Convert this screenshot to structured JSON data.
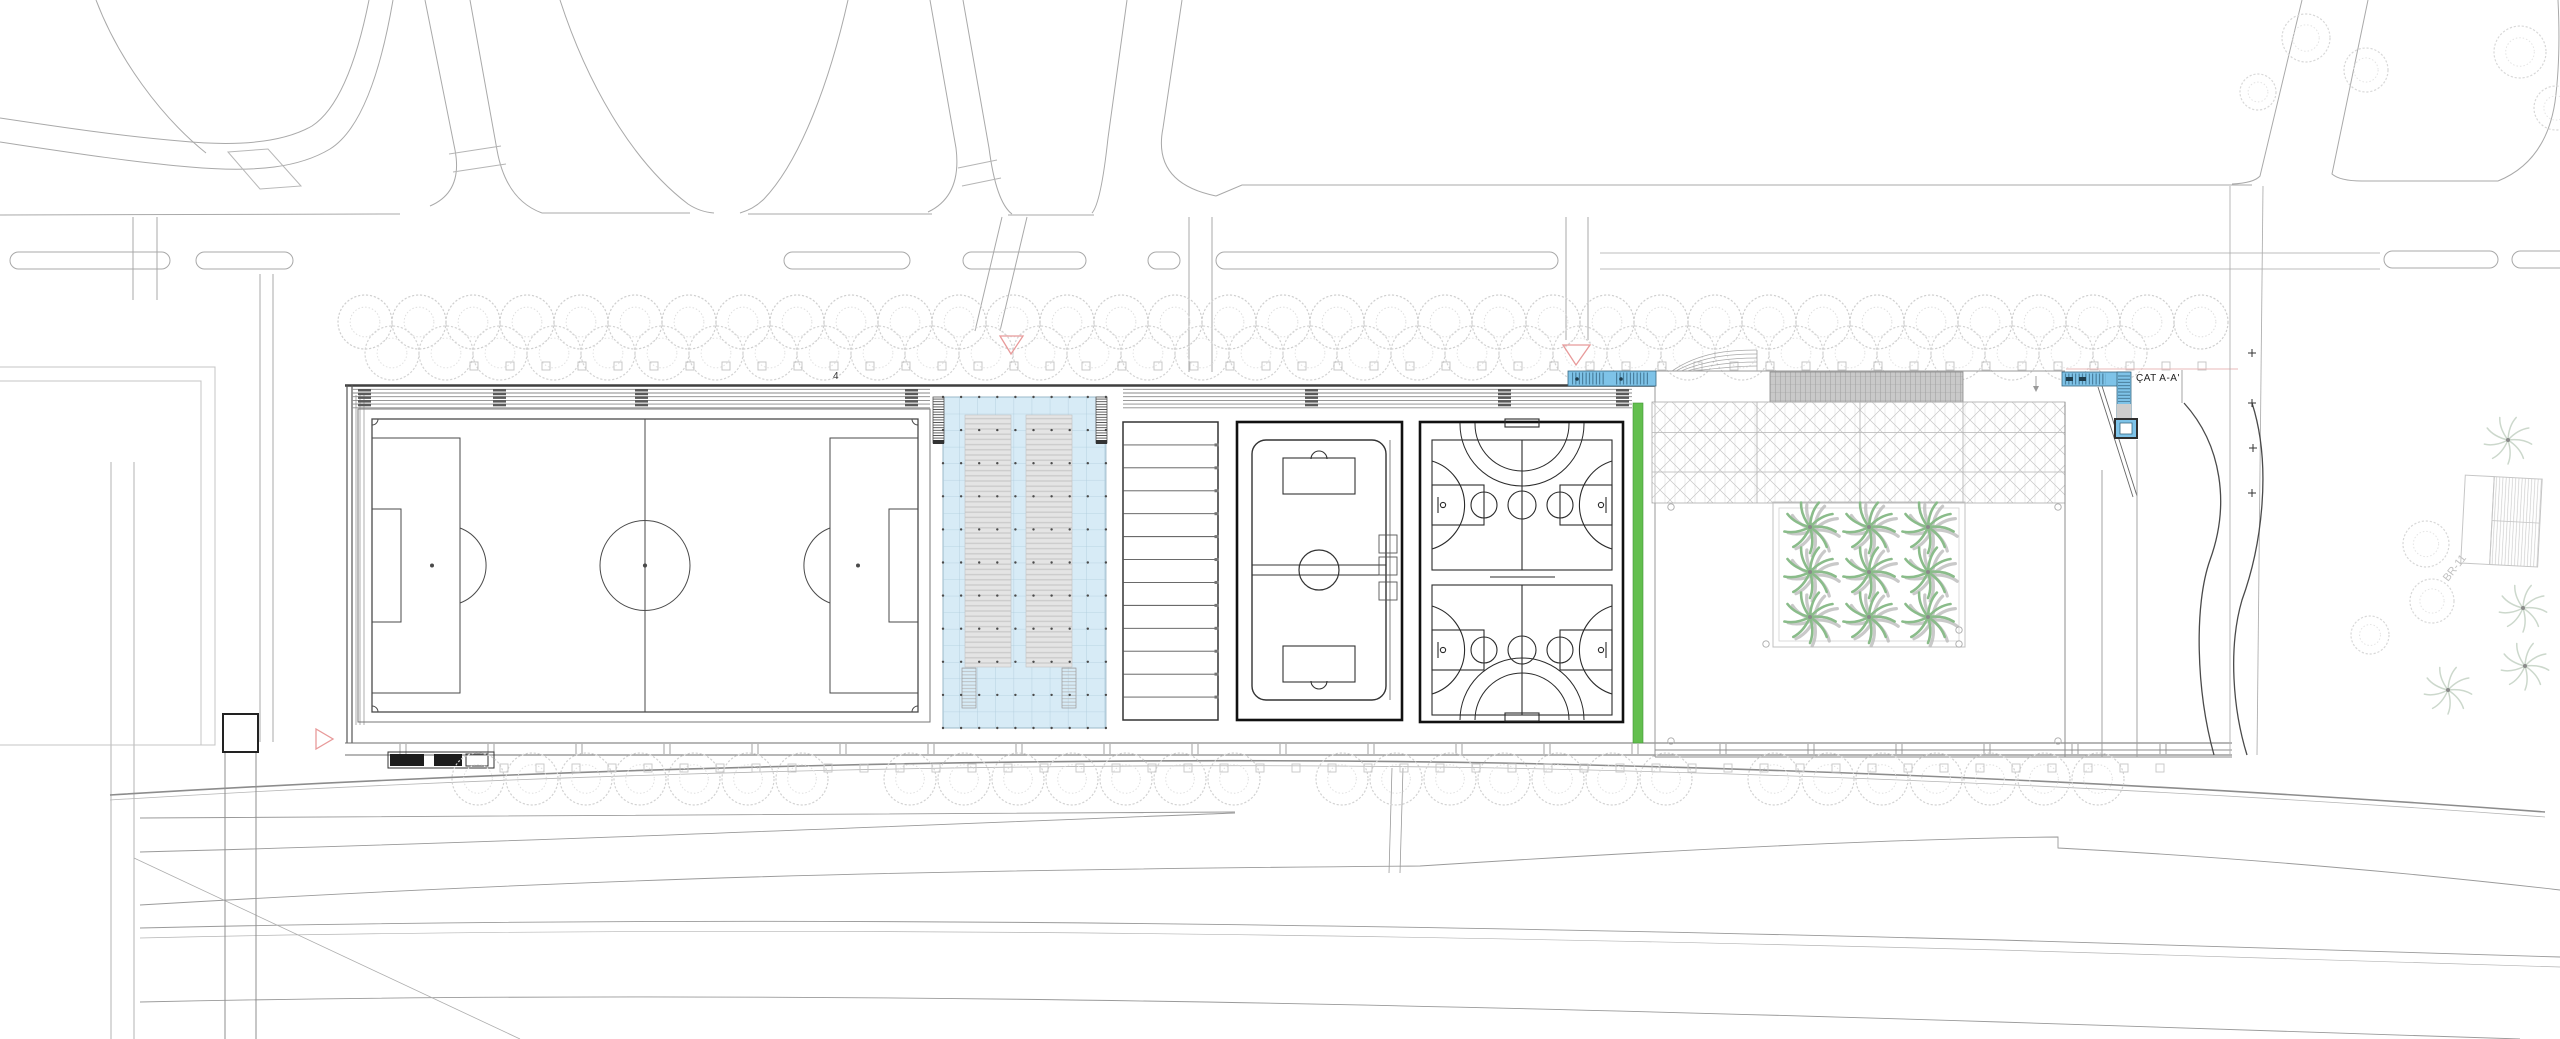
{
  "labels": {
    "section": "ÇAT A-A'",
    "stand_bay": "4",
    "parcel": "BR-11"
  },
  "palette": {
    "pool_blue": "#d7ebf6",
    "stair_blue": "#7ec3e8",
    "lawn_green": "#63bf4e",
    "palm_green": "#8abc8a",
    "marker_pink": "#e89a9a",
    "road_line": "#a9a9a9",
    "site_line": "#3f3f3f",
    "tree_gray": "#cfcfcf"
  },
  "features": {
    "football_fields": 1,
    "shaded_pool_canopies": 1,
    "terrace_step_count": 12,
    "handball_courts": 1,
    "basketball_courts": 2,
    "palm_courtyard_grid": "3 x 3",
    "top_tree_rows": 2,
    "bottom_tree_rows": 1
  }
}
